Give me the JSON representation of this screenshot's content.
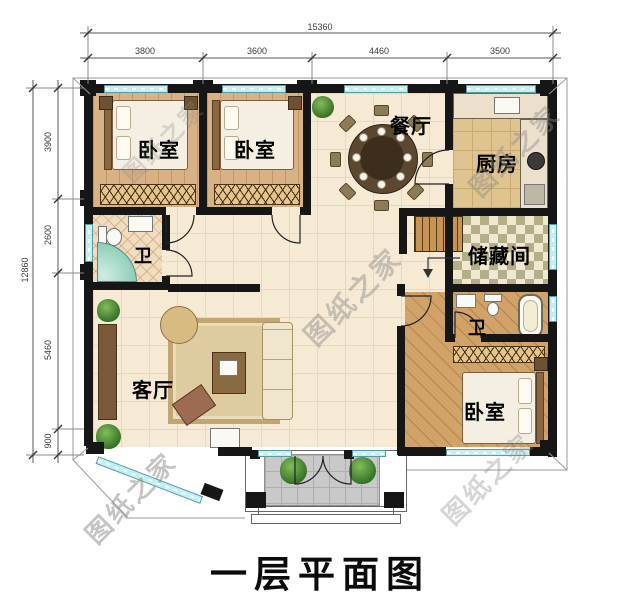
{
  "title": "一层平面图",
  "watermark_text": "图纸之家",
  "dimensions": {
    "top_total": "15360",
    "top_segments": [
      "3800",
      "3600",
      "4460",
      "3500"
    ],
    "left_total": "12860",
    "left_segments": [
      "3900",
      "2600",
      "5460",
      "900"
    ]
  },
  "rooms": {
    "bedroom1": "卧室",
    "bedroom2": "卧室",
    "bedroom3": "卧室",
    "dining": "餐厅",
    "kitchen": "厨房",
    "bath1": "卫",
    "bath2": "卫",
    "storage": "储藏间",
    "living": "客厅"
  },
  "colors": {
    "wall": "#161616",
    "window": "#c2eff1",
    "floor": "#f7ead4",
    "watermark": "#8a8a8a"
  }
}
